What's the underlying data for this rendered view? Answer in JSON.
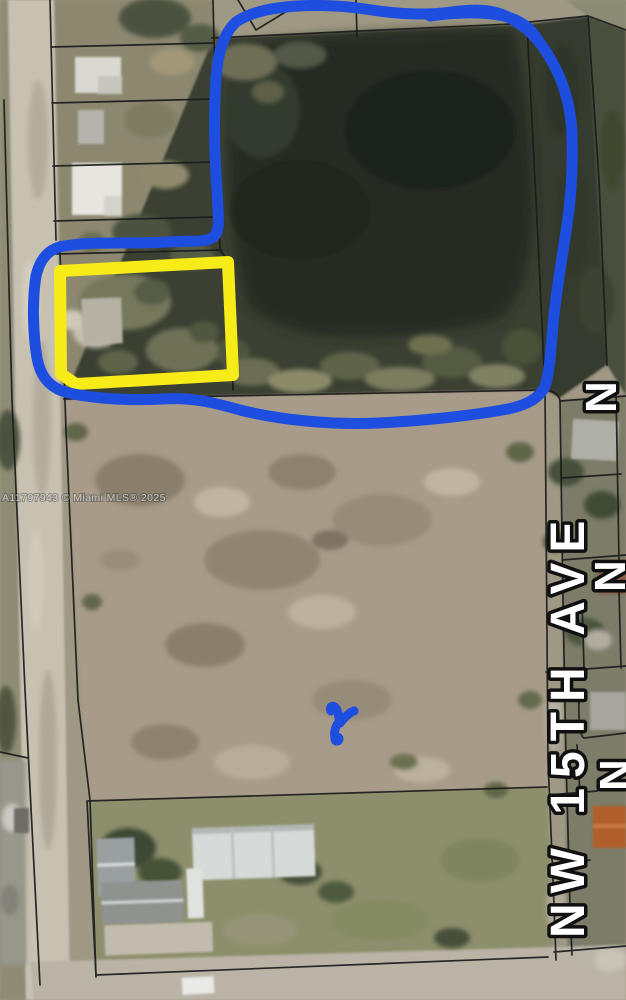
{
  "map": {
    "watermark": "A11797943 © Miami MLS® 2025",
    "street_label": "NW 15TH AVE",
    "edge_labels": [
      "N",
      "N",
      "N"
    ],
    "palette": {
      "annotation_blue": "#1e4ee0",
      "annotation_yellow": "#f7ec17",
      "label_fill": "#ffffff",
      "label_outline": "#101010",
      "watermark_color": "rgba(255,255,255,0.62)",
      "watermark_shadow": "rgba(40,40,40,0.45)",
      "parcel_line": "#1c1c1c",
      "pond_water": "#262c24",
      "tree_dark": "#3a4132",
      "dirt_lot": "#a89b89",
      "road": "#c7c1b2",
      "grass": "#8d8f6c"
    }
  }
}
